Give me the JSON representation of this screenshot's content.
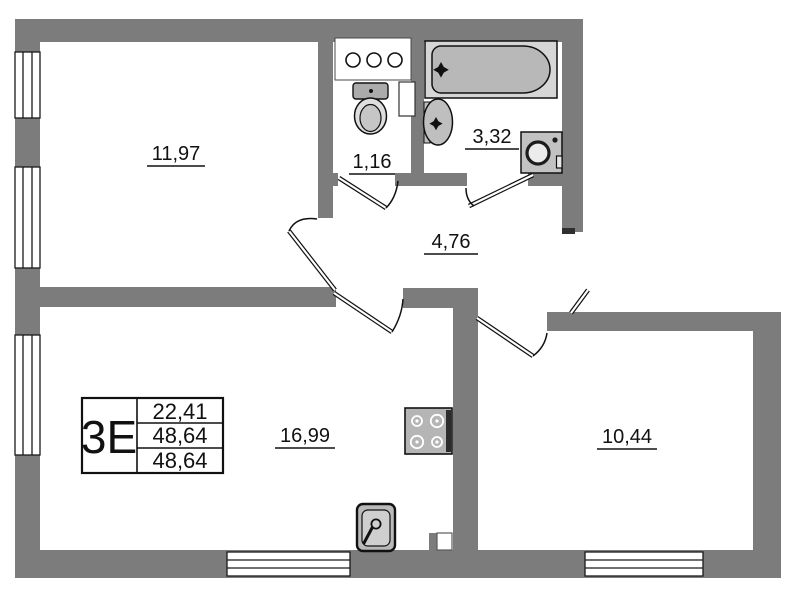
{
  "plan": {
    "stamp": {
      "unit_label": "3E",
      "values": [
        "22,41",
        "48,64",
        "48,64"
      ]
    },
    "rooms": [
      {
        "name": "room-top-left",
        "area": "11,97"
      },
      {
        "name": "wc",
        "area": "1,16"
      },
      {
        "name": "bathroom",
        "area": "3,32"
      },
      {
        "name": "hallway",
        "area": "4,76"
      },
      {
        "name": "kitchen-living-room",
        "area": "16,99"
      },
      {
        "name": "bedroom",
        "area": "10,44"
      }
    ],
    "fixtures": [
      "bathtub",
      "wash-basin",
      "toilet",
      "vent-shelf",
      "washing-machine",
      "stove",
      "kitchen-sink"
    ],
    "colors": {
      "wall": "#7c7c7c",
      "line": "#111111",
      "fixture_fill": "#c2c2c2",
      "background": "#ffffff"
    }
  }
}
